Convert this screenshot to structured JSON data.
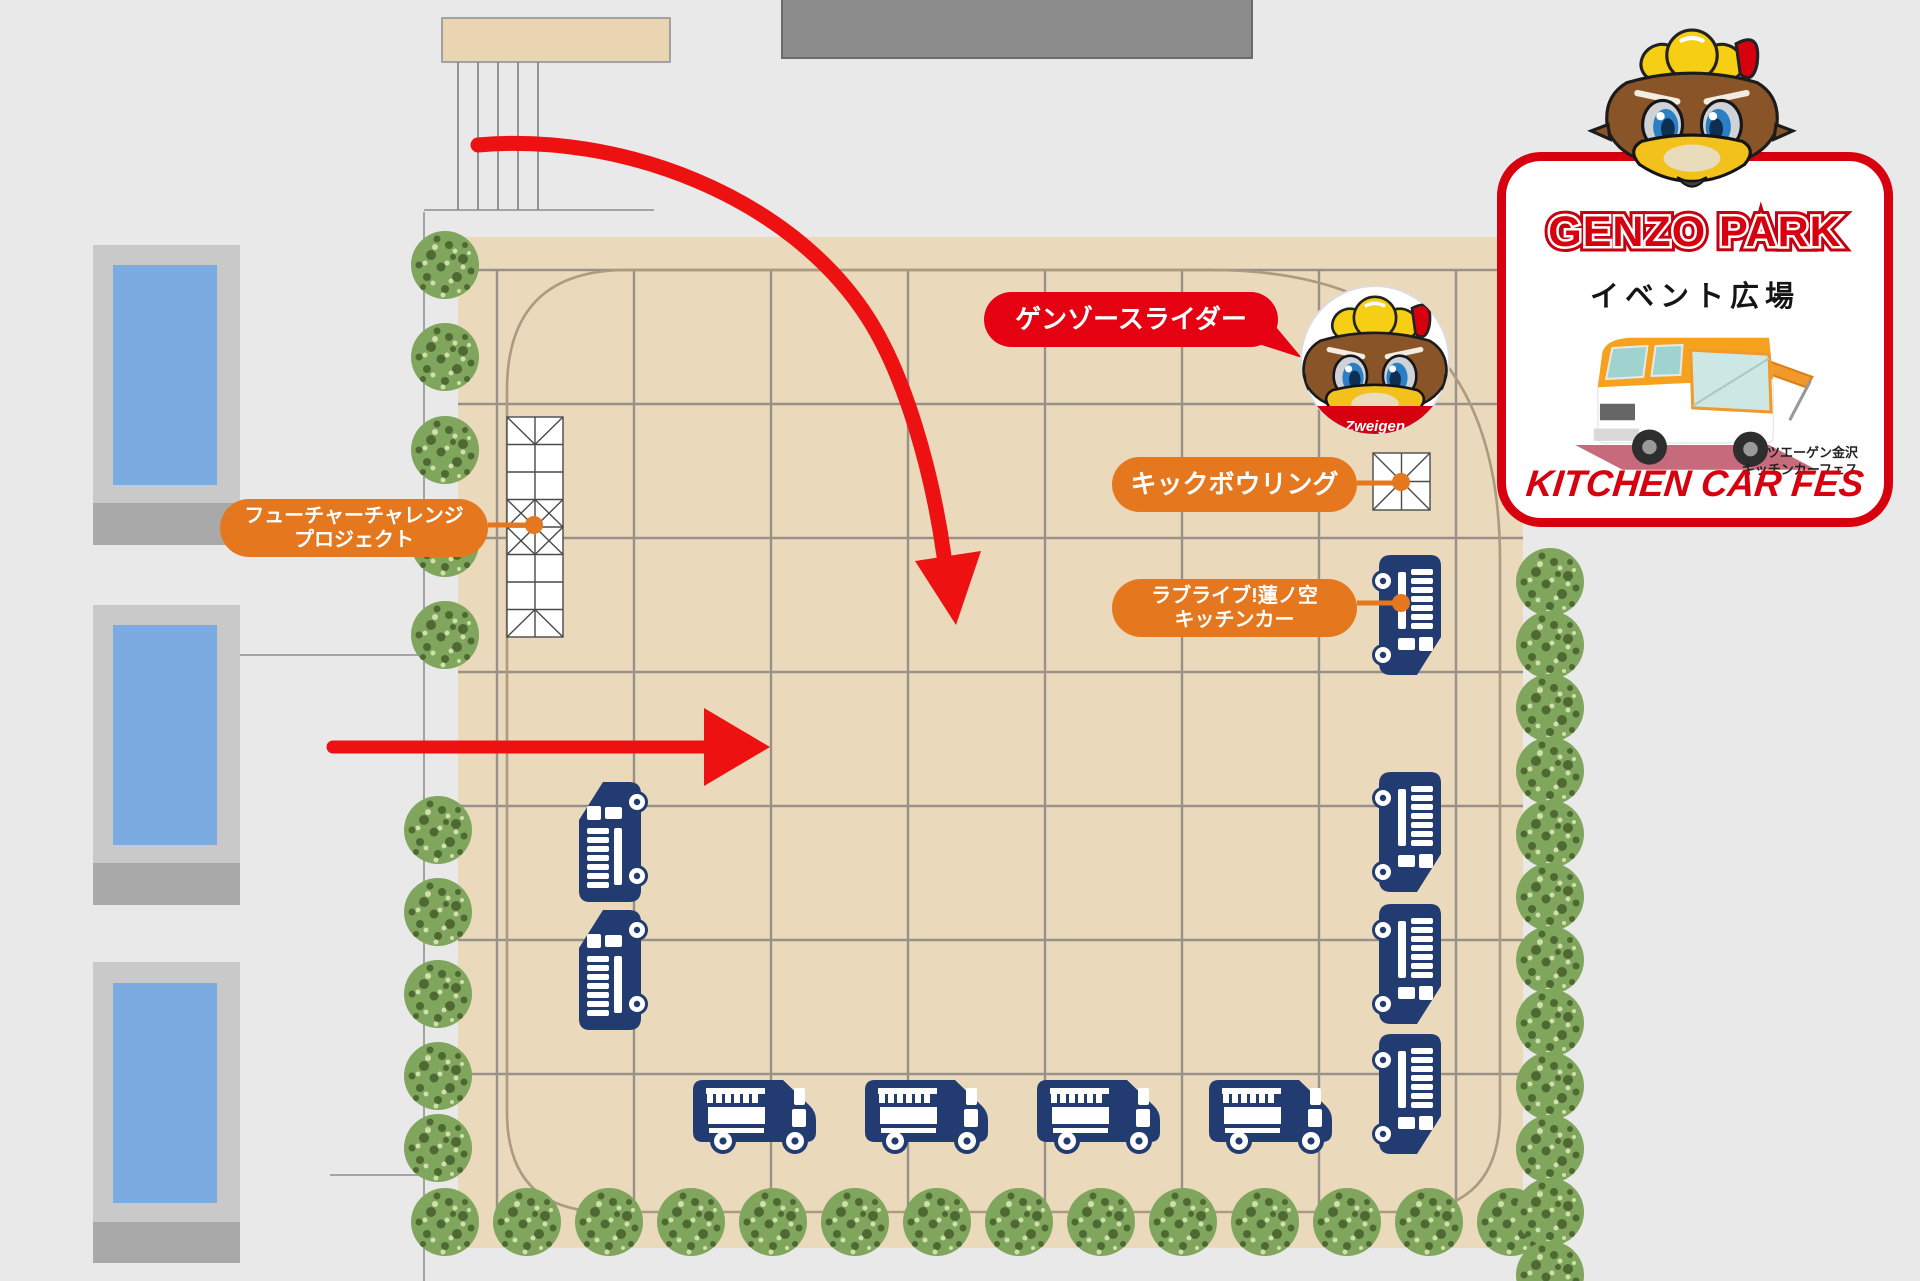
{
  "map": {
    "labels": {
      "future_challenge": {
        "line1": "フューチャーチャレンジ",
        "line2": "プロジェクト"
      },
      "genzo_slider": "ゲンゾースライダー",
      "kick_bowling": "キックボウリング",
      "love_live": {
        "line1": "ラブライブ!蓮ノ空",
        "line2": "キッチンカー"
      }
    },
    "mascot_photo_caption": "Zweigen"
  },
  "logo": {
    "title": "GENZO PARK",
    "subtitle": "イベント広場",
    "credit_line1": "ツエーゲン金沢",
    "credit_line2": "キッチンカーフェス",
    "footer": "KITCHEN CAR FES"
  },
  "icons": {
    "tree": "tree-icon",
    "kitchen_truck_top": "kitchen-truck-top-icon",
    "kitchen_truck_side": "kitchen-truck-side-icon",
    "tent": "tent-icon",
    "bird_mascot": "bird-mascot-icon",
    "entrance_arrow": "entrance-arrow"
  },
  "colors": {
    "plaza": "#ebd9bb",
    "grid_line": "#98918a",
    "path_line": "#ab9b80",
    "truck_navy": "#223c72",
    "label_orange": "#e5781e",
    "label_red": "#e50012",
    "arrow_red": "#ee1111",
    "logo_red": "#d7000f",
    "building_window_blue": "#7cabe2",
    "street_gray": "#e9e9e9"
  }
}
